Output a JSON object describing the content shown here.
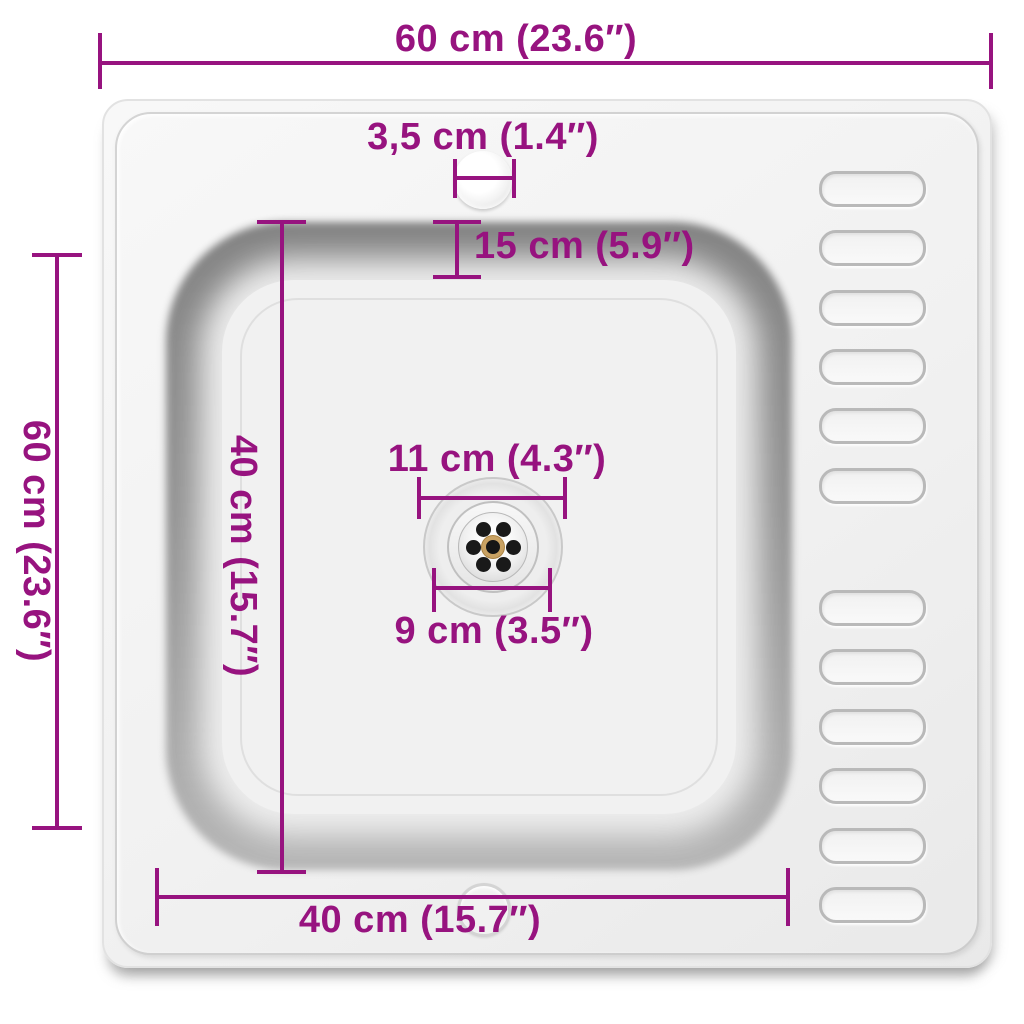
{
  "diagram": {
    "subject": "inset-kitchen-sink-top-view",
    "colors": {
      "dimension": "#97137F",
      "plate": "#f0f0f0",
      "basin_rim": "#8a8a8a",
      "basin_floor": "#f1f1f1",
      "drain_center_ring": "#c9a263",
      "background": "#ffffff"
    },
    "dimensions": {
      "overall_width": {
        "label": "60 cm (23.6″)",
        "value_cm": 60,
        "value_in": 23.6
      },
      "overall_depth": {
        "label": "60 cm (23.6″)",
        "value_cm": 60,
        "value_in": 23.6
      },
      "faucet_hole_diameter": {
        "label": "3,5 cm (1.4″)",
        "value_cm": 3.5,
        "value_in": 1.4
      },
      "basin_top_inset": {
        "label": "15 cm (5.9″)",
        "value_cm": 15,
        "value_in": 5.9
      },
      "basin_depth": {
        "label": "40 cm (15.7″)",
        "value_cm": 40,
        "value_in": 15.7
      },
      "basin_width": {
        "label": "40 cm (15.7″)",
        "value_cm": 40,
        "value_in": 15.7
      },
      "drain_outer_diameter": {
        "label": "11 cm (4.3″)",
        "value_cm": 11,
        "value_in": 4.3
      },
      "drain_inner_diameter": {
        "label": "9 cm (3.5″)",
        "value_cm": 9,
        "value_in": 3.5
      }
    },
    "drainboard": {
      "groove_count": 12,
      "groove_left": 819,
      "groove_width": 107,
      "groove_height": 36,
      "groove_tops": [
        171,
        230,
        290,
        349,
        408,
        468,
        590,
        649,
        709,
        768,
        828,
        887
      ]
    },
    "drain": {
      "center": {
        "x": 493,
        "y": 547
      },
      "strainer_hole_count": 7,
      "hole_ring_radius": 20,
      "hole_radius": 7.5,
      "hole_angles_deg": [
        0,
        60,
        120,
        180,
        240,
        300
      ]
    }
  }
}
